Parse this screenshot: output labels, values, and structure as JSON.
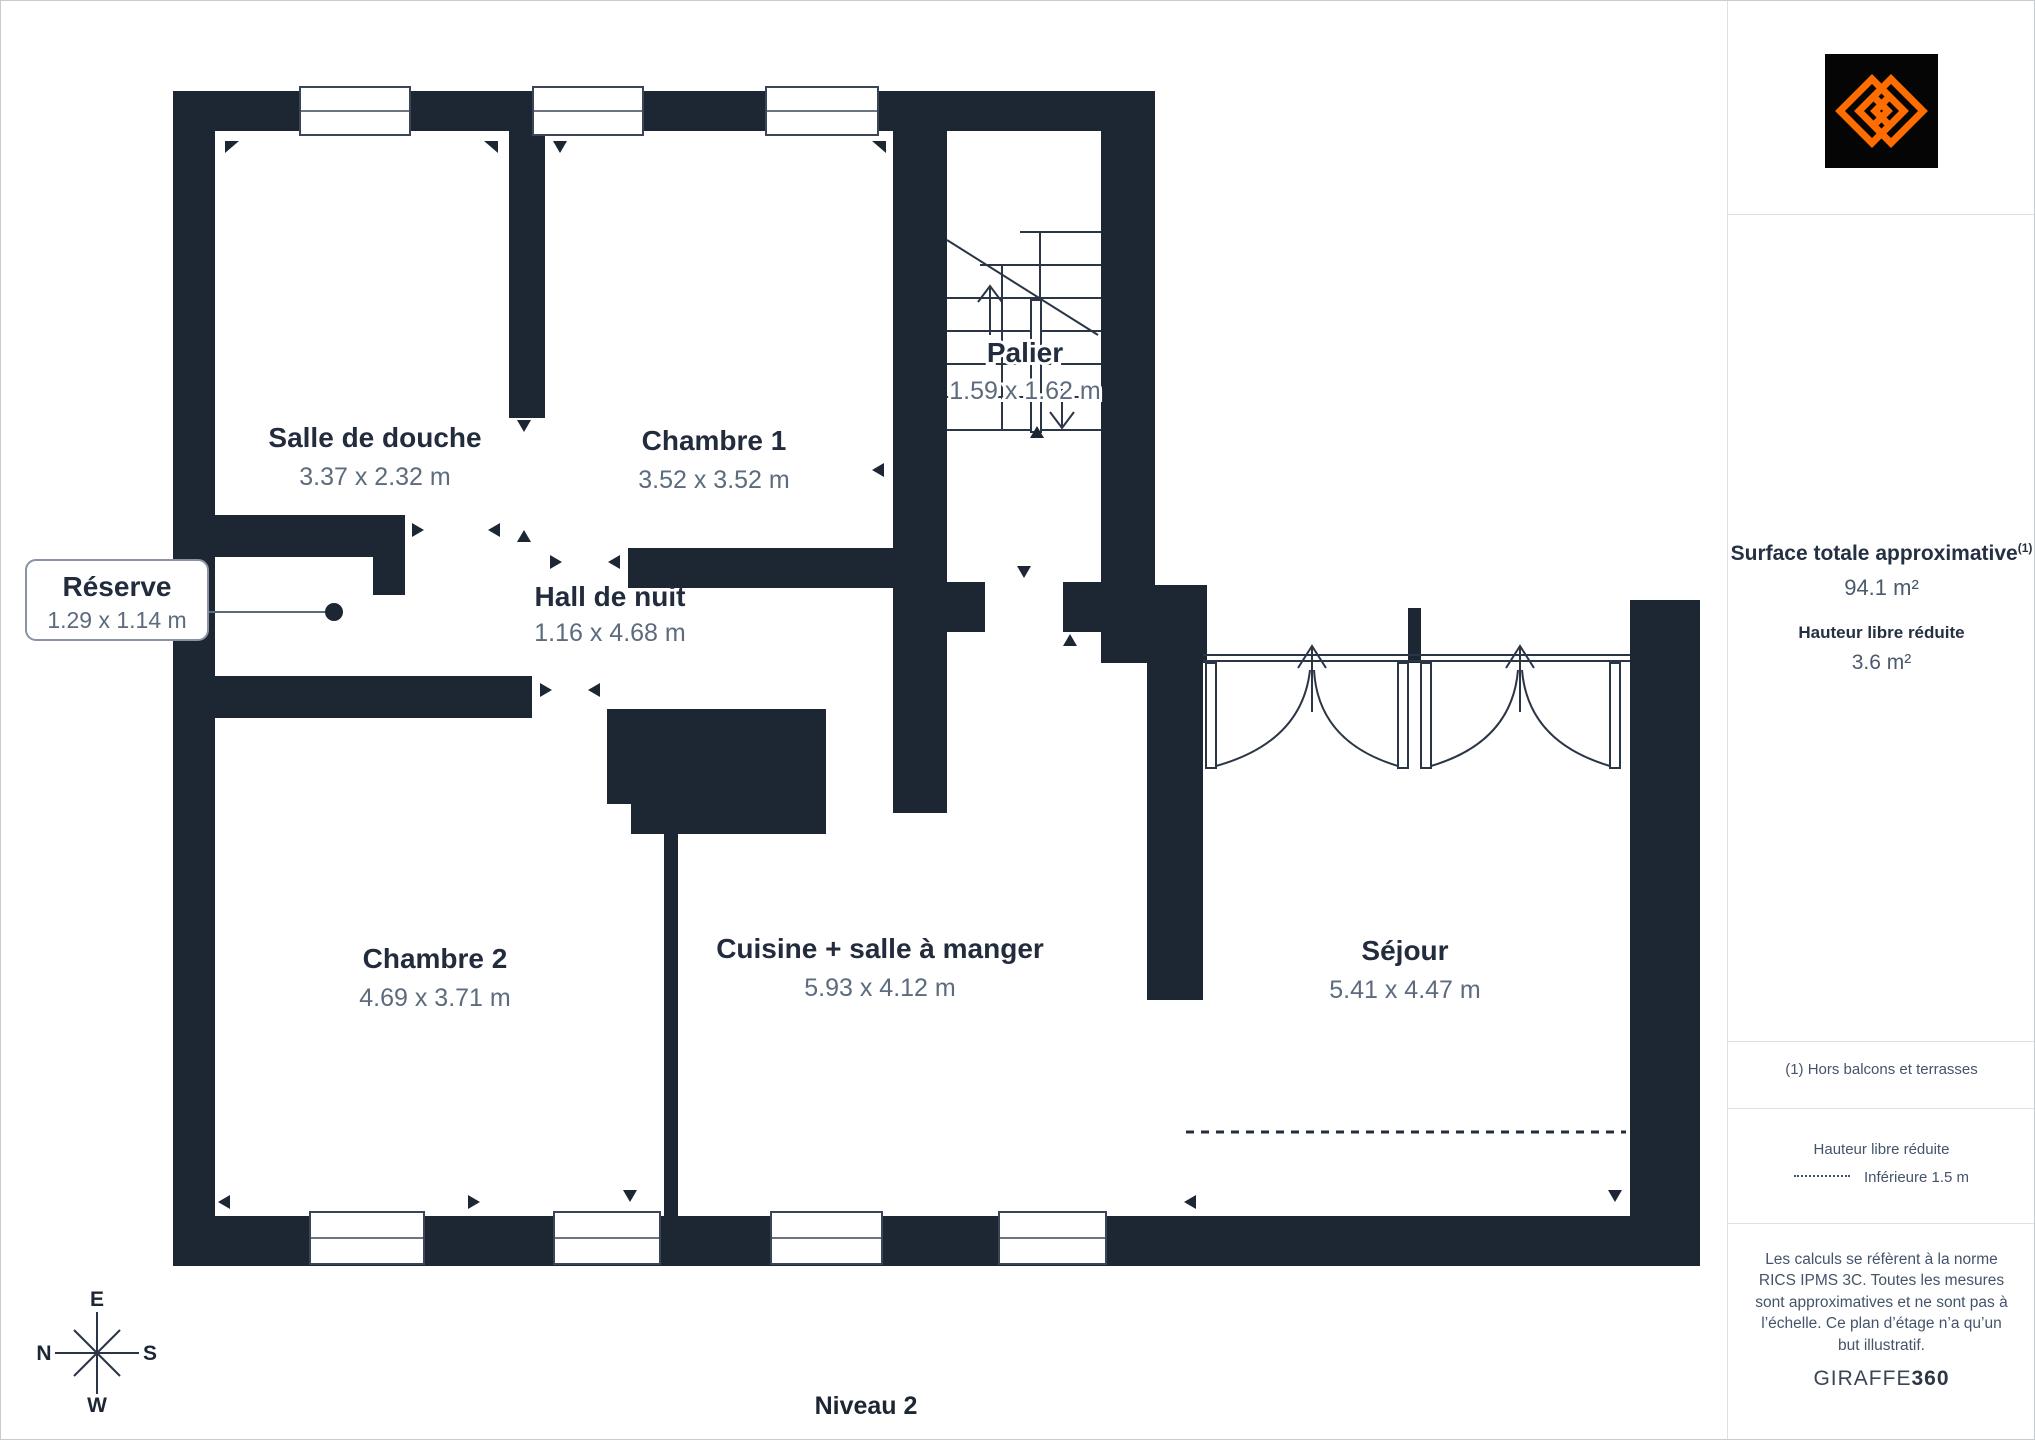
{
  "plan": {
    "level_label": "Niveau 2",
    "rooms": [
      {
        "name": "Salle de douche",
        "dims": "3.37 x 2.32 m"
      },
      {
        "name": "Chambre 1",
        "dims": "3.52 x 3.52 m"
      },
      {
        "name": "Palier",
        "dims": "1.59 x 1.62 m"
      },
      {
        "name": "Réserve",
        "dims": "1.29 x 1.14 m"
      },
      {
        "name": "Hall de nuit",
        "dims": "1.16 x 4.68 m"
      },
      {
        "name": "Chambre 2",
        "dims": "4.69 x 3.71 m"
      },
      {
        "name": "Cuisine + salle à manger",
        "dims": "5.93 x 4.12 m"
      },
      {
        "name": "Séjour",
        "dims": "5.41 x 4.47 m"
      }
    ],
    "compass": {
      "top": "E",
      "left": "N",
      "right": "S",
      "bottom": "W"
    }
  },
  "sidebar": {
    "surface_title": "Surface totale approximative",
    "surface_title_sup": "(1)",
    "surface_value": "94.1 m²",
    "height_title": "Hauteur libre réduite",
    "height_value": "3.6 m²",
    "footnote": "(1) Hors balcons et terrasses",
    "legend_title": "Hauteur libre réduite",
    "legend_value": "Inférieure 1.5 m",
    "disclaimer": "Les calculs se réfèrent à la norme RICS IPMS 3C. Toutes les mesures sont approximatives et ne sont pas à l’échelle. Ce plan d’étage n’a qu’un but illustratif.",
    "brand": "GIRAFFE",
    "brand_suffix": "360"
  },
  "colors": {
    "wall": "#1d2633",
    "room_name": "#222c3c",
    "room_dims": "#5c6b7d",
    "accent_orange": "#ff6d00",
    "sidebar_text": "#44546a"
  }
}
